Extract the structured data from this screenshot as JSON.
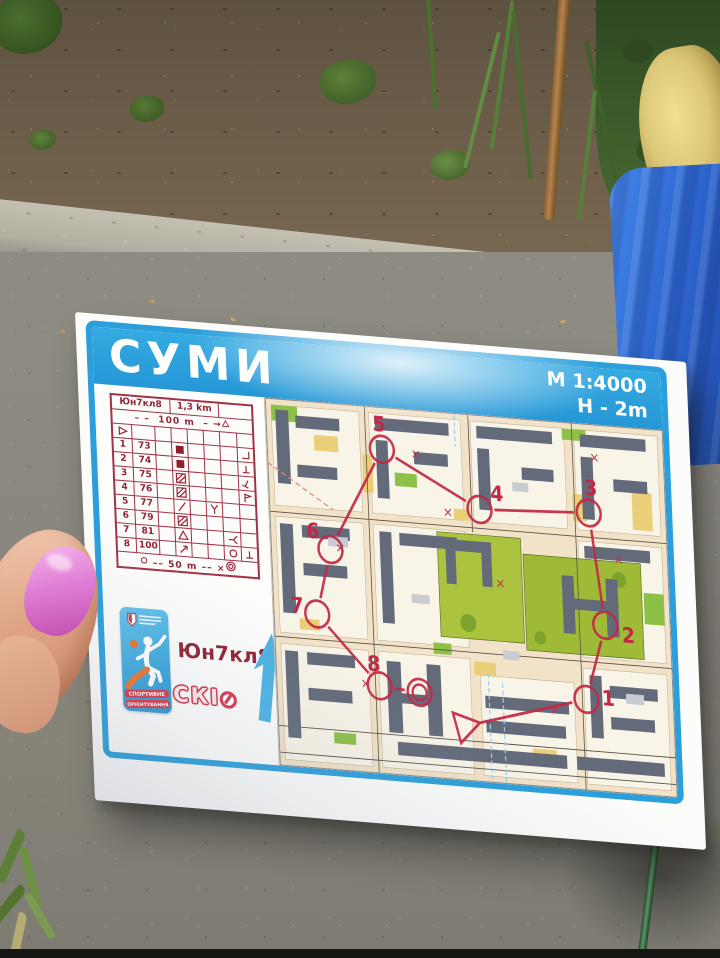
{
  "map_sheet": {
    "title": "СУМИ",
    "scale": "M 1:4000",
    "climb": "H - 2m",
    "class_label": "Юн7кл8",
    "club": "СКІО",
    "club_letters": "СКІ",
    "palette": {
      "banner_blue": "#2a9fdc",
      "card_maroon": "#a23347",
      "course_red": "#c22845",
      "building_gray": "#636b7a",
      "park_green": "#a3bd3c",
      "open_yellow": "#ebcf78",
      "paved_tan": "#f1e2c8",
      "nail_pink": "#e07fd6"
    },
    "sticker": {
      "ribbon1": "СПОРТИВНЕ",
      "ribbon2": "ОРІЄНТУВАННЯ"
    },
    "control_card": {
      "class": "Юн7кл8",
      "length": "1,3 km",
      "route_distance": "100 m",
      "finish_distance": "50 m",
      "rows": [
        {
          "num": "1",
          "code": "73",
          "symbols": {
            "D": "filled-square"
          },
          "H": "corner-se"
        },
        {
          "num": "2",
          "code": "74",
          "symbols": {
            "D": "filled-square"
          },
          "H": "t-bar"
        },
        {
          "num": "3",
          "code": "75",
          "symbols": {
            "D": "hatched-square"
          },
          "H": "t-bar-tilt"
        },
        {
          "num": "4",
          "code": "76",
          "symbols": {
            "D": "hatched-square"
          },
          "H": "flag"
        },
        {
          "num": "5",
          "code": "77",
          "symbols": {
            "D": "slash",
            "F": "fork"
          },
          "H": ""
        },
        {
          "num": "6",
          "code": "79",
          "symbols": {
            "D": "hatched-square"
          },
          "H": ""
        },
        {
          "num": "7",
          "code": "81",
          "symbols": {
            "D": "triangle",
            "G": "bend"
          },
          "H": ""
        },
        {
          "num": "8",
          "code": "100",
          "symbols": {
            "D": "arrow-ne",
            "G": "circle"
          },
          "H": "t-bar"
        }
      ]
    },
    "course": {
      "color": "#c22845",
      "sequence": [
        "start",
        "1",
        "2",
        "3",
        "4",
        "5",
        "6",
        "7",
        "8",
        "finish"
      ],
      "points": {
        "start": {
          "kind": "start",
          "x": 188,
          "y": 281
        },
        "finish": {
          "kind": "finish",
          "x": 144,
          "y": 254
        },
        "1": {
          "kind": "control",
          "x": 312,
          "y": 248,
          "lx": 22,
          "ly": 4
        },
        "2": {
          "kind": "control",
          "x": 334,
          "y": 180,
          "lx": 23,
          "ly": 14
        },
        "3": {
          "kind": "control",
          "x": 322,
          "y": 80,
          "lx": 3,
          "ly": -16
        },
        "4": {
          "kind": "control",
          "x": 212,
          "y": 85,
          "lx": 18,
          "ly": -9
        },
        "5": {
          "kind": "control",
          "x": 116,
          "y": 38,
          "lx": -2,
          "ly": -16
        },
        "6": {
          "kind": "control",
          "x": 60,
          "y": 132,
          "lx": -17,
          "ly": -9
        },
        "7": {
          "kind": "control",
          "x": 44,
          "y": 191,
          "lx": -20,
          "ly": 0
        },
        "8": {
          "kind": "control",
          "x": 104,
          "y": 251,
          "lx": -5,
          "ly": -13
        }
      }
    }
  }
}
